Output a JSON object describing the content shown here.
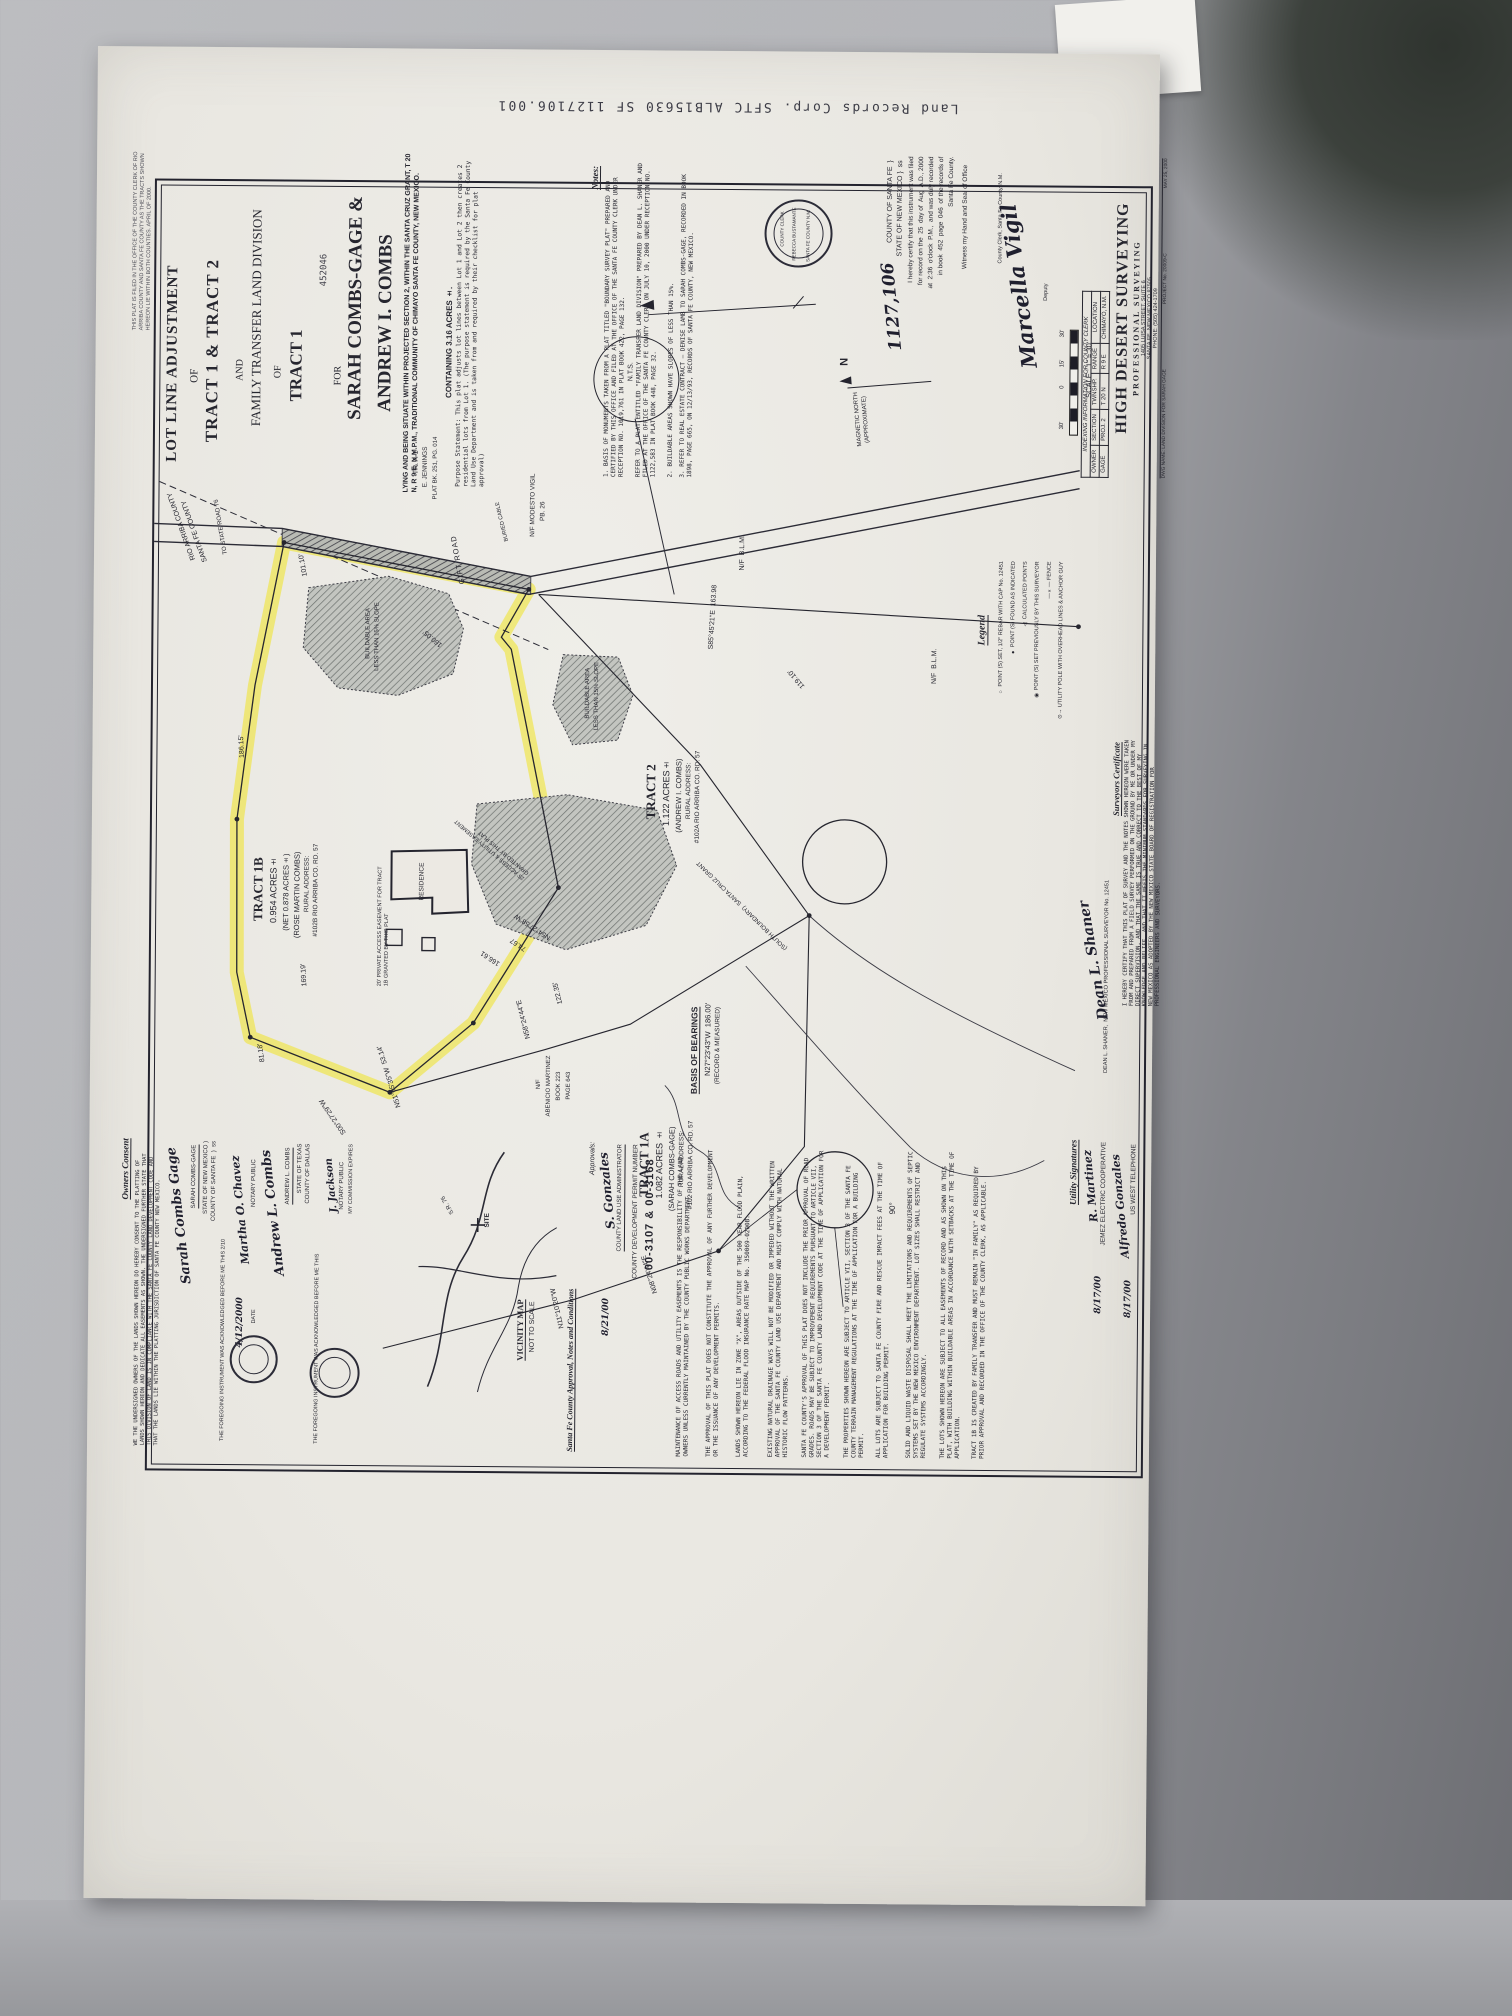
{
  "photo": {
    "stamp_line": "Land Records Corp. SFTC ALB15630 SF 1127106.001"
  },
  "title_block": {
    "l1": "LOT LINE ADJUSTMENT",
    "l2": "OF",
    "l3": "TRACT 1 & TRACT 2",
    "l4": "AND",
    "l5": "FAMILY TRANSFER LAND DIVISION",
    "l6": "OF",
    "l7": "TRACT 1",
    "stamp_no": "452046",
    "l8": "FOR",
    "name1": "SARAH COMBS-GAGE &",
    "name2": "ANDREW I. COMBS",
    "situate": "LYING AND BEING SITUATE WITHIN PROJECTED SECTION 2, WITHIN THE SANTA CRUZ GRANT, T 20 N, R 9 E, N.M.P.M., TRADITIONAL COMMUNITY OF CHIMAYO SANTA FE COUNTY, NEW MEXICO.",
    "containing": "CONTAINING 3.16 ACRES ±.",
    "margin_note": "THIS PLAT IS FILED IN THE OFFICE OF THE COUNTY CLERK OF RIO ARRIBA COUNTY AND SANTA FE COUNTY AS THE TRACTS SHOWN HEREON LIE WITHIN BOTH COUNTIES. APRIL OF 2000."
  },
  "purpose": "Purpose Statement:  This plat adjusts lot lines between Lot 1 and Lot 2 then creates 2 residential lots from Lot 1. (The purpose statement is required by the Santa Fe County Land Use Department and is taken from and required by their checklist for plat approval)",
  "notes": {
    "header": "Notes:",
    "n1": "1.  BASIS OF MONUMENTS TAKEN FROM A PLAT TITLED \"BOUNDARY SURVEY PLAT\" PREPARED AND CERTIFIED BY THIS OFFICE AND FILED AT THE OFFICE OF THE SANTA FE COUNTY CLERK UNDER RECEPTION NO. 1019,761 IN PLAT BOOK 422, PAGE 132.",
    "n1b": "REFER TO A PLAT ENTITLED \"FAMILY TRANSFER LAND DIVISION\" PREPARED BY DEAN L. SHANER AND FILED AT THE OFFICE OF THE SANTA FE COUNTY CLERK ON JULY 10, 2000 UNDER RECEPTION NO. 1122,583 IN PLAT BOOK 448, PAGE 32.",
    "n2": "2.  BUILDABLE AREAS SHOWN HAVE SLOPES OF LESS THAN 15%.",
    "n3": "3.  REFER TO REAL ESTATE CONTRACT – DENISE LAMB TO SARAH COMBS-GAGE, RECORDED IN BOOK 1898, PAGE 665, ON 12/13/93, RECORDS OF SANTA FE COUNTY, NEW MEXICO."
  },
  "clerk_seal": {
    "t1": "COUNTY CLERK",
    "t2": "REBECCA BUSTAMANTE",
    "t3": "SANTA FE COUNTY N.M."
  },
  "recording": {
    "number": "1127,106",
    "l1": "COUNTY OF SANTA FE  }",
    "l2": "STATE OF NEW MEXICO }  ss",
    "l3": "I hereby certify that this instrument was filed",
    "l4": "for record on the  25  day of  Aug  A.D., 2000",
    "l5": "at  2:36  o'clock  P.M.,  and was duly recorded",
    "l6": "in book  452  page  046  of the records of",
    "l7": "Santa Fe County.",
    "l8": "Witness my Hand and Seal of Office",
    "sig": "Marcella Vigil",
    "sig_title": "County Clerk, Santa Fe County, N.M.",
    "deputy": "Deputy"
  },
  "north": {
    "label1": "MAGNETIC NORTH",
    "label2": "(APPROXIMATE)",
    "n": "N"
  },
  "scale": {
    "label": "SCALE : 1\" = 30'",
    "t30a": "30'",
    "t15": "15'",
    "t0": "0",
    "t30b": "30'"
  },
  "indexing": {
    "header": "INDEXING INFORMATION FOR COUNTY CLERK",
    "c1": "OWNER",
    "c2": "SECTION",
    "c3": "TWNSHP.",
    "c4": "RANGE",
    "c5": "LOCATION",
    "v1": "GAGE",
    "v2": "PROJ. 2",
    "v3": "T 20 N",
    "v4": "R 9 E",
    "v5": "CHIMAYO, N.M."
  },
  "company": {
    "name": "HIGH DESERT SURVEYING",
    "sub": "PROFESSIONAL SURVEYING",
    "addr1": "1405 LUISA STREET, SUITE 6",
    "addr2": "SANTA FE, NEW MEXICO 87505",
    "phone": "PHONE: (505) 424-1709",
    "dwg": "DWG NAME: LAND DIVISION FOR SARAH GAGE",
    "proj": "PROJECT No. 20009-C",
    "date": "MAY 25, 2000"
  },
  "legend": {
    "header": "Legend",
    "items": [
      {
        "sym": "○",
        "label": "POINT (S) SET, 1/2\" REBAR WITH CAP No. 12451"
      },
      {
        "sym": "●",
        "label": "POINT (S) FOUND AS INDICATED"
      },
      {
        "sym": "△",
        "label": "CALCULATED POINTS"
      },
      {
        "sym": "◉",
        "label": "POINT (S) SET PREVIOUSLY BY THIS SURVEYOR"
      },
      {
        "sym": "—×—",
        "label": "FENCE"
      },
      {
        "sym": "⊙→",
        "label": "UTILITY POLE WITH OVERHEAD LINES & ANCHOR GUY"
      }
    ]
  },
  "surveyor": {
    "header": "Surveyors Certificate",
    "body": "I HEREBY CERTIFY THAT THIS PLAT OF SURVEY AND THE NOTES SHOWN HEREON WERE TAKEN FROM AND PREPARED FROM A FIELD SURVEY PERFORMED ON THE GROUND BY ME OR UNDER MY DIRECT SUPERVISION, AND THAT THE SAME IS TRUE AND CORRECT TO THE BEST OF MY KNOWLEDGE AND BELIEF, AND THAT IT MEETS THE MINIMUM STANDARDS FOR SURVEYING IN NEW MEXICO AS ADOPTED BY THE NEW MEXICO STATE BOARD OF REGISTRATION FOR PROFESSIONAL ENGINEERS AND SURVEYORS.",
    "sig": "Dean L. Shaner",
    "name": "DEAN L. SHANER,  NEW MEXICO PROFESSIONAL SURVEYOR No. 12451"
  },
  "utilities": {
    "header": "Utility Signatures",
    "sig1": "R. Martinez",
    "co1": "JEMEZ ELECTRIC COOPERATIVE",
    "date1": "8/17/00",
    "sig2": "Alfredo Gonzales",
    "co2": "US WEST TELEPHONE",
    "date2": "8/17/00"
  },
  "owners": {
    "header": "Owners Consent",
    "body": "WE THE UNDERSIGNED OWNERS OF THE LANDS SHOWN HEREON DO HEREBY CONSENT TO THE PLATTING OF LANDS SHOWN HEREON AND DEDICATE ALL EASEMENTS AS SHOWN. THE UNDERSIGNED FURTHER STATE THAT THIS DIVISION OF LAND IS IN COMPLIANCE WITH THE SANTA FE COUNTY LAND DEVELOPMENT CODE AND THAT THE LANDS LIE WITHIN THE PLATTING JURISDICTION OF SANTA FE COUNTY NEW MEXICO.",
    "sig1": "Sarah Combs Gage",
    "name1": "SARAH COMBS-GAGE",
    "ack1a": "STATE OF NEW MEXICO )",
    "ack1b": "COUNTY OF SANTA FE  )  ss",
    "ack1": "THE FOREGOING INSTRUMENT WAS ACKNOWLEDGED BEFORE ME THIS 2/10",
    "notary1_sig": "Martha O. Chavez",
    "notary1": "NOTARY PUBLIC",
    "date1": "4/12/2000",
    "date_label": "DATE",
    "sig2": "Andrew L. Combs",
    "name2": "ANDREW L. COMBS",
    "ack2a": "STATE OF TEXAS",
    "ack2b": "COUNTY OF DALLAS",
    "ack2": "THE FOREGOING INSTRUMENT WAS ACKNOWLEDGED BEFORE ME THIS",
    "notary2_sig": "J. Jackson",
    "notary2": "NOTARY PUBLIC",
    "exp": "MY COMMISSION EXPIRES"
  },
  "vicinity": {
    "label1": "VICINITY MAP",
    "label2": "NOT TO SCALE",
    "site": "SITE",
    "road": "S.R. 76"
  },
  "approval": {
    "header": "Santa Fe County Approval, Notes and Conditions",
    "approvals": "Approvals:",
    "sig": "S. Gonzales",
    "title1": "COUNTY LAND USE ADMINISTRATOR",
    "date": "8/21/00",
    "permit_label": "COUNTY DEVELOPMENT PERMIT NUMBER",
    "permit_no": "00-3107 & 00-3168"
  },
  "conditions": [
    "MAINTENANCE OF ACCESS ROADS AND UTILITY EASEMENTS IS THE RESPONSIBILITY OF THE LAND OWNERS UNLESS CURRENTLY MAINTAINED BY THE COUNTY PUBLIC WORKS DEPARTMENT.",
    "THE APPROVAL OF THIS PLAT DOES NOT CONSTITUTE THE APPROVAL OF ANY FURTHER DEVELOPMENT OR THE ISSUANCE OF ANY DEVELOPMENT PERMITS.",
    "LANDS SHOWN HEREON LIE IN ZONE \"X\", AREAS OUTSIDE OF THE 500 YEAR FLOOD PLAIN, ACCORDING TO THE FEDERAL FLOOD INSURANCE RATE MAP No. 350069-0200B.",
    "EXISTING NATURAL DRAINAGE WAYS WILL NOT BE MODIFIED OR IMPEDED WITHOUT THE WRITTEN APPROVAL OF THE SANTA FE COUNTY LAND USE DEPARTMENT AND MUST COMPLY WITH NATURAL HISTORIC FLOW PATTERNS.",
    "SANTA FE COUNTY'S APPROVAL OF THIS PLAT DOES NOT INCLUDE THE PRIOR APPROVAL OF ROAD GRADES. ROADS MAY BE SUBJECT TO IMPROVEMENT REQUIREMENTS PURSUANT TO ARTICLE VII, SECTION 3 OF THE SANTA FE COUNTY LAND DEVELOPMENT CODE AT THE TIME OF APPLICATION FOR A DEVELOPMENT PERMIT.",
    "THE PROPERTIES SHOWN HEREON ARE SUBJECT TO ARTICLE VII, SECTION 3 OF THE SANTA FE COUNTY TERRAIN MANAGEMENT REGULATIONS AT THE TIME OF APPLICATION FOR A BUILDING PERMIT.",
    "ALL LOTS ARE SUBJECT TO SANTA FE COUNTY FIRE AND RESCUE IMPACT FEES AT THE TIME OF APPLICATION FOR BUILDING PERMIT.",
    "SOLID AND LIQUID WASTE DISPOSAL SHALL MEET THE LIMITATIONS AND REQUIREMENTS OF SEPTIC SYSTEMS SET BY THE NEW MEXICO ENVIRONMENT DEPARTMENT. LOT SIZES SHALL RESTRICT AND REGULATE SYSTEMS ACCORDINGLY.",
    "THE LOTS SHOWN HEREON ARE SUBJECT TO ALL EASEMENTS OF RECORD AND AS SHOWN ON THIS PLAT, WITH BUILDING WITHIN BUILDABLE AREAS IN ACCORDANCE WITH SETBACKS AT THE TIME OF APPLICATION.",
    "TRACT 1B IS CREATED BY FAMILY TRANSFER AND MUST REMAIN \"IN FAMILY\" AS REQUIRED BY PRIOR APPROVAL AND RECORDED IN THE OFFICE OF THE COUNTY CLERK, AS APPLICABLE."
  ],
  "map": {
    "roads": {
      "gift_road": "GIFT ROAD",
      "to_sr76": "TO STATE ROAD 76",
      "buried_cable": "BURIED CABLE"
    },
    "counties": {
      "rio_arriba": "RIO ARRIBA COUNTY",
      "santa_fe": "SANTA FE COUNTY"
    },
    "adjoiners": {
      "tr_a1_1": "TR. A-1",
      "tr_a1_2": "E. JENNINGS",
      "tr_a1_3": "PLAT BK. 251, PG. 014",
      "vigil1": "N/F MODESTO VIGIL",
      "vigil2": "PB. 26",
      "blm": "N/F  B.L.M.",
      "martinez1": "N/F",
      "martinez2": "ABENICIO MARTINEZ",
      "martinez3": "BOOK 223",
      "martinez4": "PAGE 643"
    },
    "tract1b": {
      "name": "TRACT 1B",
      "area": "0.954 ACRES±",
      "net": "(NET 0.878 ACRES±)",
      "owner": "(ROSE MARTIN COMBS)",
      "addr1": "RURAL ADDRESS:",
      "addr2": "#102B RIO ARRIBA CO. RD. 57"
    },
    "tract1a": {
      "name": "TRACT 1A",
      "area": "1.082 ACRES ±",
      "owner": "(SARAH COMBS-GAGE)",
      "addr1": "RURAL ADDRESS:",
      "addr2": "#102 RIO ARRIBA CO. RD. 57"
    },
    "tract2": {
      "name": "TRACT 2",
      "area": "1.122 ACRES±",
      "owner": "(ANDREW I. COMBS)",
      "addr1": "RURAL ADDRESS:",
      "addr2": "#102A RIO ARRIBA CO. RD. 57"
    },
    "bearings": [
      "N54°27'58\"W",
      "74.67",
      "166.61",
      "169.19'",
      "186.15'",
      "N51°05'35\"W  53.14'",
      "N58°24'44\"E",
      "122.35'",
      "N11°10'20\"W",
      "N08°24'44\"E",
      "S85°45'21\"E  163.98",
      "S00°27'29\"W",
      "81.18'",
      "160.05'",
      "101.10'",
      "119.10'"
    ],
    "easements": {
      "e20": "20' PRIVATE ACCESS EASEMENT FOR TRACT 1B GRANTED BY THIS PLAT",
      "e25": "25' ACCESS & UTILITY EASEMENT GRANTED BY THIS PLAT",
      "scg": "(SOUTH BOUNDARY)  SANTA CRUZ GRANT"
    },
    "areas": {
      "b1": "BUILDABLE AREA",
      "b2": "LESS THAN 15% SLOPE",
      "residence": "RESIDENCE",
      "nts": "N.T.S.",
      "ninety": "90°"
    },
    "basis": {
      "h": "BASIS OF BEARINGS",
      "b": "N27°23'43\"W  186.00'",
      "c": "(RECORD & MEASURED)"
    }
  }
}
